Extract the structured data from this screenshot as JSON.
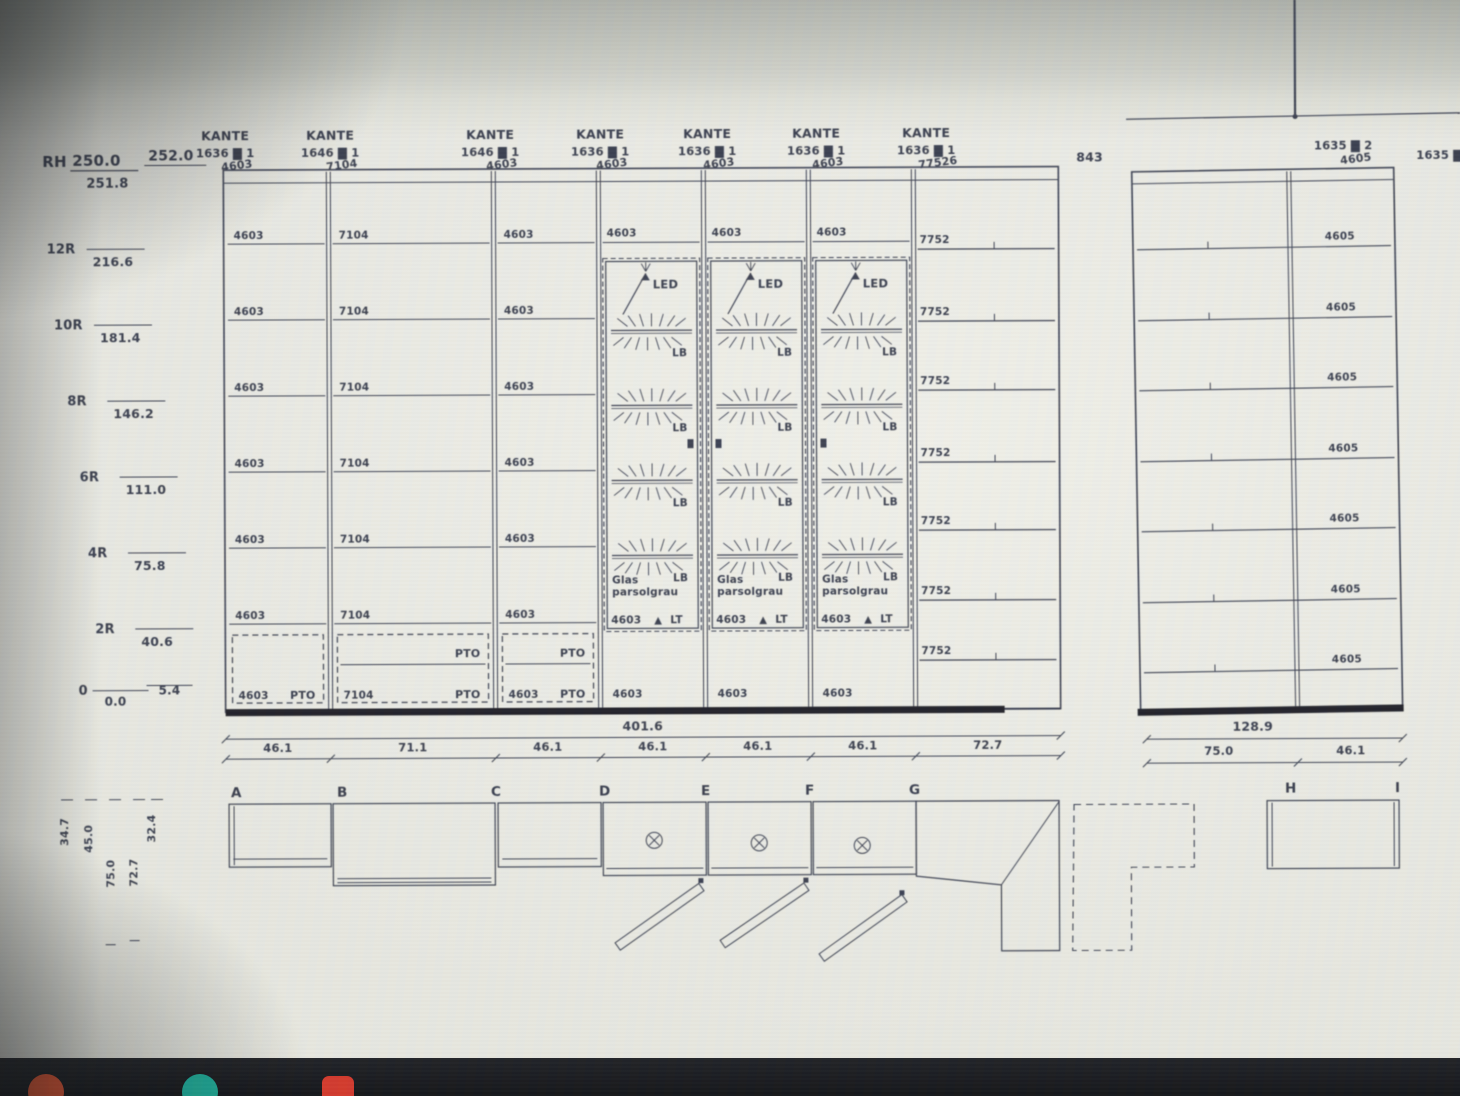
{
  "photo": {
    "ink_color": "#3d4252",
    "paper_color": "#e8e9e2",
    "heavy_line_color": "#20232a",
    "taskbar_color": "#17191d",
    "dock_icons": [
      {
        "name": "orange-app-icon",
        "shape": "circle",
        "color": "#e0522f"
      },
      {
        "name": "teal-app-icon",
        "shape": "circle",
        "color": "#1dae9a"
      },
      {
        "name": "red-app-icon",
        "shape": "square",
        "color": "#d43a2c"
      }
    ]
  },
  "glyphs": {
    "redacted": "▇",
    "triangle": "▲"
  },
  "header": {
    "room_height": {
      "label": "RH",
      "upper": "250.0",
      "lower": "251.8",
      "right": "252.0"
    }
  },
  "left_scale": {
    "rows": [
      {
        "name": "12R",
        "value": "216.6",
        "cm": 216.6
      },
      {
        "name": "10R",
        "value": "181.4",
        "cm": 181.4
      },
      {
        "name": "8R",
        "value": "146.2",
        "cm": 146.2
      },
      {
        "name": "6R",
        "value": "111.0",
        "cm": 111.0
      },
      {
        "name": "4R",
        "value": "75.8",
        "cm": 75.8
      },
      {
        "name": "2R",
        "value": "40.6",
        "cm": 40.6
      },
      {
        "name": "0",
        "value": "0.0",
        "cm": 0
      }
    ],
    "baseline_offset": "5.4"
  },
  "kante_labels": [
    {
      "title": "KANTE",
      "dim": "1636",
      "count": "1",
      "code": "4603"
    },
    {
      "title": "KANTE",
      "dim": "1646",
      "count": "1",
      "code": "7104"
    },
    {
      "title": "KANTE",
      "dim": "1646",
      "count": "1",
      "code": "4603"
    },
    {
      "title": "KANTE",
      "dim": "1636",
      "count": "1",
      "code": "4603"
    },
    {
      "title": "KANTE",
      "dim": "1636",
      "count": "1",
      "code": "4603"
    },
    {
      "title": "KANTE",
      "dim": "1636",
      "count": "1",
      "code": "4603"
    },
    {
      "title": "KANTE",
      "dim": "1636",
      "count": "1",
      "code": "77526"
    }
  ],
  "top_right": {
    "wall_dim": "843",
    "right_unit_label": {
      "dim": "1635",
      "count": "2",
      "code": "4605"
    },
    "edge_label": {
      "dim": "1635"
    }
  },
  "main_unit": {
    "total_width": "401.6",
    "sections": [
      {
        "letter": "A",
        "width": "46.1",
        "shelf_code": "4603",
        "type": "open"
      },
      {
        "letter": "B",
        "width": "71.1",
        "shelf_code": "7104",
        "type": "open"
      },
      {
        "letter": "C",
        "width": "46.1",
        "shelf_code": "4603",
        "type": "open"
      },
      {
        "letter": "D",
        "width": "46.1",
        "shelf_code": "4603",
        "type": "glass"
      },
      {
        "letter": "E",
        "width": "46.1",
        "shelf_code": "4603",
        "type": "glass"
      },
      {
        "letter": "F",
        "width": "46.1",
        "shelf_code": "4603",
        "type": "glass"
      },
      {
        "letter": "G",
        "width": "72.7",
        "shelf_code": "7752",
        "type": "open"
      }
    ],
    "glass_door": {
      "led": "LED",
      "shelf_light": "LB",
      "glass_text_1": "Glas",
      "glass_text_2": "parsolgrau",
      "bottom_code": "4603",
      "bottom_tag": "LT"
    },
    "pto_tag": "PTO"
  },
  "right_unit": {
    "total_width": "128.9",
    "sections": [
      {
        "letter": "H",
        "width": "75.0"
      },
      {
        "letter": "I",
        "width": "46.1",
        "shelf_code": "4605"
      }
    ]
  },
  "plan": {
    "depth_labels": [
      "34.7",
      "45.0",
      "75.0",
      "72.7",
      "32.4"
    ]
  }
}
